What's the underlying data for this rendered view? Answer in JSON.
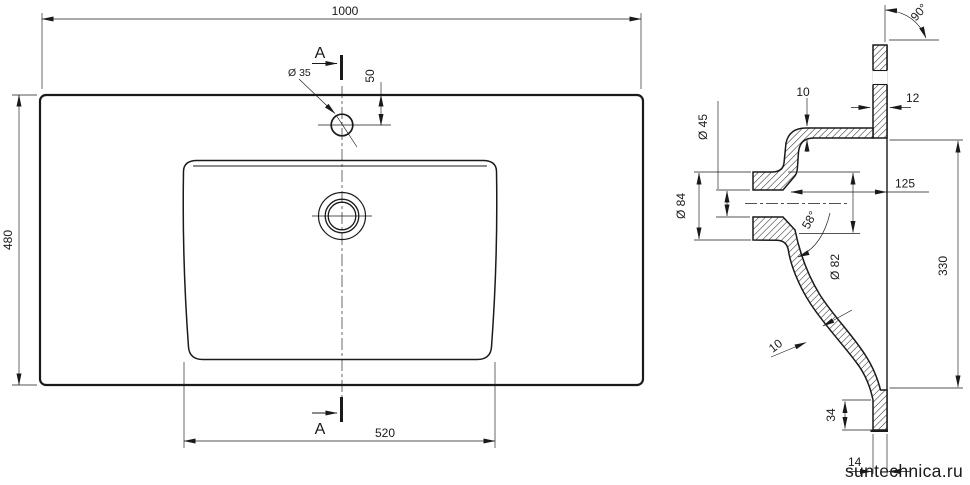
{
  "dims": {
    "overall_width": "1000",
    "overall_depth": "480",
    "basin_bottom_width": "520",
    "faucet_hole_diameter": "Ø 35",
    "faucet_hole_offset": "50",
    "section_mark": "A",
    "corner_angle": "90°",
    "deck_edge_thickness": "12",
    "rim_wall_thickness": "10",
    "drain_bore_diameter": "Ø 45",
    "drain_flange_diameter": "Ø 84",
    "drain_center_depth": "125",
    "drain_cone_angle": "58°",
    "drain_cone_diameter": "Ø 82",
    "basin_opening_depth": "330",
    "bowl_wall_thickness": "10",
    "front_rim_width": "34",
    "front_lip_offset": "14"
  },
  "watermark": {
    "text": "suntechnica.ru",
    "color": "#b3b3b3"
  },
  "colors": {
    "line": "#1a1a1a",
    "background": "#ffffff"
  }
}
